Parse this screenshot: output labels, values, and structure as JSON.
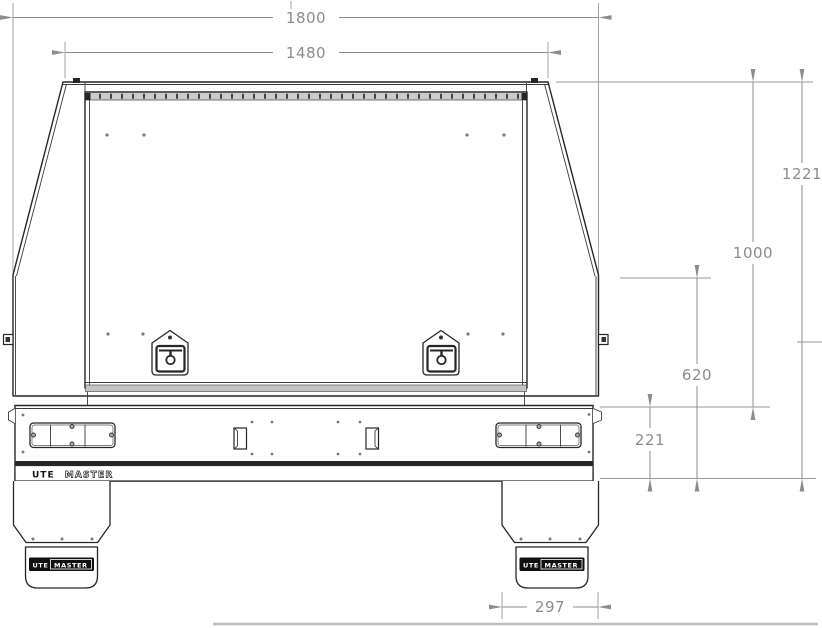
{
  "dimensions": {
    "overall_width": "1800",
    "canopy_top_width": "1480",
    "overall_height": "1221",
    "canopy_height": "1000",
    "handle_height": "620",
    "tray_side_height": "221",
    "mudflap_width": "297"
  },
  "branding": {
    "tray_logo_part1": "UTE",
    "tray_logo_part2": "MASTER",
    "mudflap_left_part1": "UTE",
    "mudflap_left_part2": "MASTER",
    "mudflap_right_part1": "UTE",
    "mudflap_right_part2": "MASTER"
  },
  "colors": {
    "drawing_line": "#262626",
    "dimension_gray": "#8c8c8c",
    "hinge_fill": "#cccccc",
    "badge_background": "#111111",
    "ground_line": "#b4c1ca"
  }
}
